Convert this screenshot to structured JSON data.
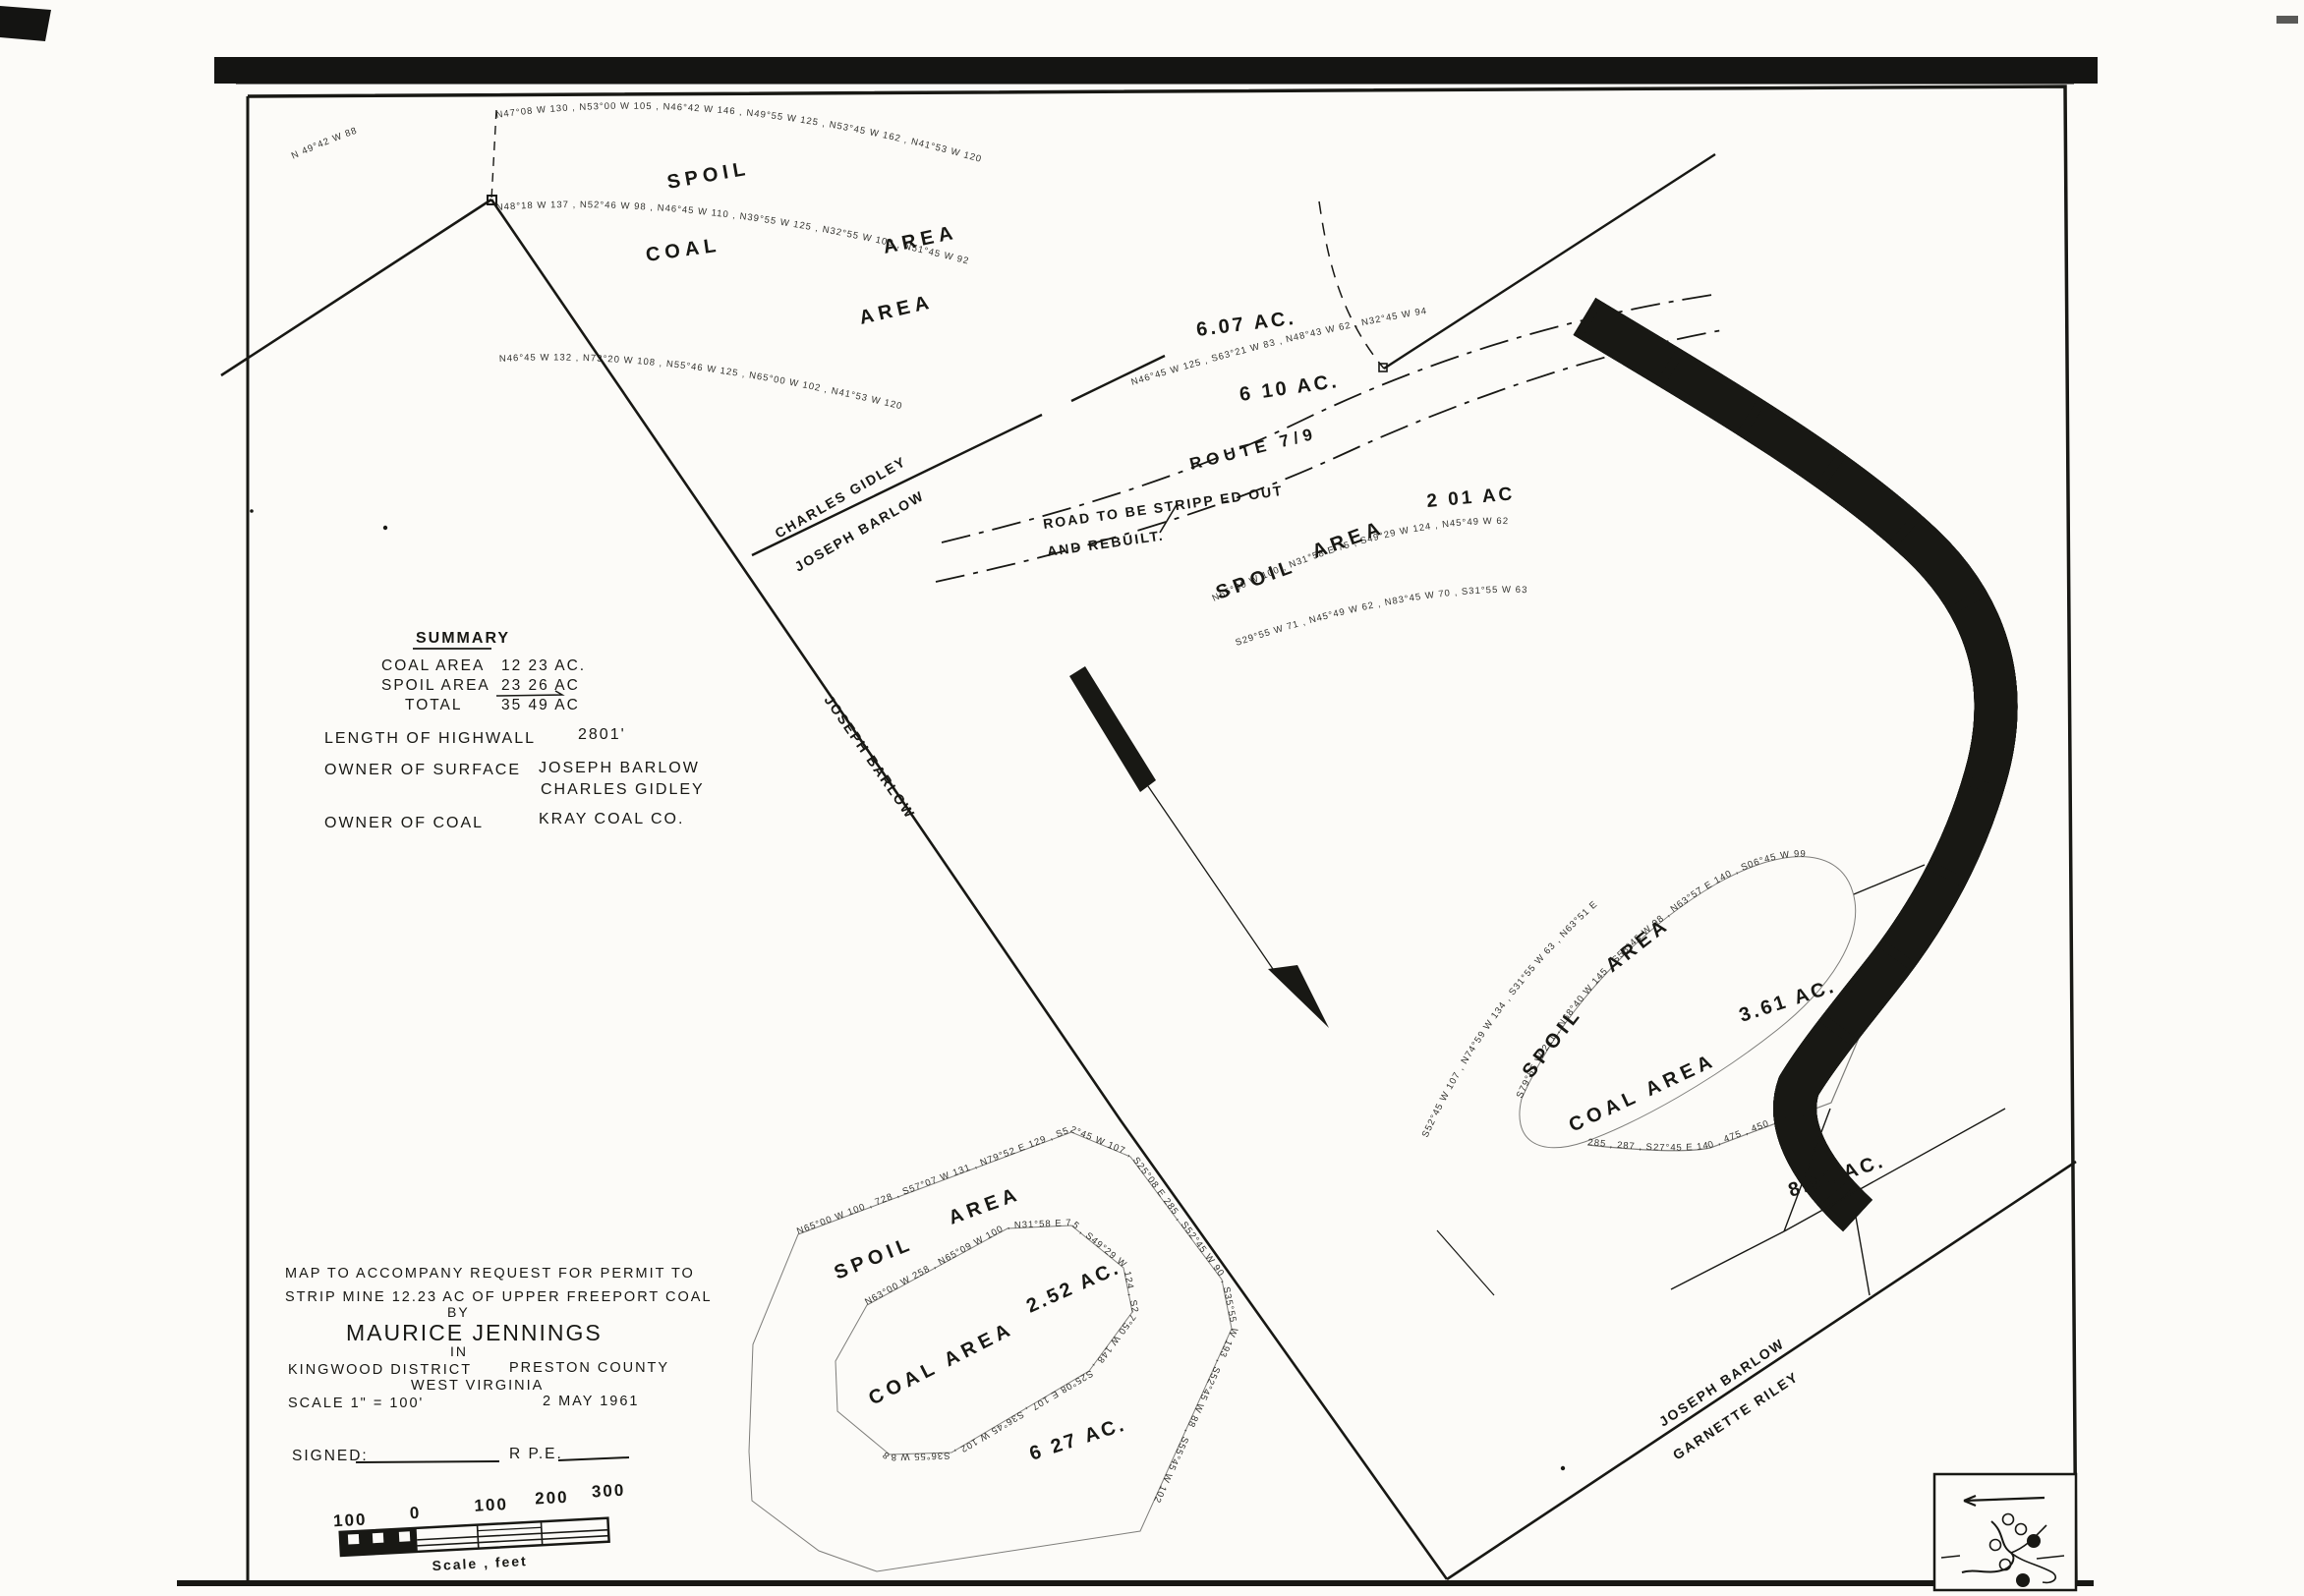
{
  "colors": {
    "ink": "#181814",
    "paper": "#fcfbf8"
  },
  "summary": {
    "heading": "SUMMARY",
    "coal_label": "COAL   AREA",
    "coal_value": "12 23  AC.",
    "spoil_label": "SPOIL  AREA",
    "spoil_value": "23 26 AC",
    "total_label": "TOTAL",
    "total_value": "35 49 AC",
    "highwall_label": "LENGTH  OF  HIGHWALL",
    "highwall_value": "2801'",
    "surface_label": "OWNER  OF  SURFACE",
    "surface_value_1": "JOSEPH  BARLOW",
    "surface_value_2": "CHARLES  GIDLEY",
    "coal_owner_label": "OWNER  OF  COAL",
    "coal_owner_value": "KRAY  COAL  CO."
  },
  "title_block": {
    "line1": "MAP  TO  ACCOMPANY  REQUEST  FOR  PERMIT  TO",
    "line2": "STRIP  MINE  12.23  AC   OF  UPPER  FREEPORT  COAL",
    "by": "BY",
    "name": "MAURICE  JENNINGS",
    "in": "IN",
    "district": "KINGWOOD  DISTRICT",
    "county": "PRESTON  COUNTY",
    "state": "WEST  VIRGINIA",
    "scale": "SCALE  1\" =  100'",
    "date": "2  MAY  1961",
    "signed_label": "SIGNED:",
    "rpe": "R P.E."
  },
  "scale_bar": {
    "l0": "100",
    "l1": "0",
    "l2": "100",
    "l3": "200",
    "l4": "300",
    "caption": "Scale , feet"
  },
  "map_labels": {
    "spoil_upper": "SPOIL",
    "area_upper": "AREA",
    "coal_upper": "COAL",
    "area_upper2": "AREA",
    "ac_607": "6.07  AC.",
    "ac_610": "6 10  AC.",
    "route": "ROUTE    7/9",
    "road_note_1": "ROAD  TO  BE  STRIPP ED  OUT",
    "road_note_2": "AND  REBUILT.",
    "ac_201": "2 01  AC",
    "spoil_mid": "SPOIL",
    "area_mid": "AREA",
    "charles_gidley": "CHARLES  GIDLEY",
    "joseph_barlow_upper": "JOSEPH  BARLOW",
    "joseph_barlow_line": "JOSEPH   BARLOW",
    "spoil_right": "SPOIL",
    "area_right": "AREA",
    "coal_area_right": "COAL  AREA",
    "ac_361": "3.61  AC.",
    "ac_891": "8.91  AC.",
    "spoil_bottom": "SPOIL",
    "area_bottom": "AREA",
    "coal_area_bottom": "COAL  AREA",
    "ac_252": "2.52  AC.",
    "ac_627": "6 27  AC.",
    "joseph_barlow_lower": "JOSEPH  BARLOW",
    "garnette_riley": "GARNETTE  RILEY"
  },
  "bearings": {
    "r0": "N 49°42 W  88",
    "r1": "N47°08 W 130 ,  N53°00 W 105 ,  N46°42 W 146 ,  N49°55 W 125 ,  N53°45 W 162 ,  N41°53 W 120",
    "r2": "N48°18 W 137 ,  N52°46 W 98 ,  N46°45 W 110 ,  N39°55 W 125 ,  N32°55 W 100 ,  N51°45 W 92",
    "r3": "N46°45 W 132 ,  N73°20 W 108 ,  N55°46 W 125 ,  N65°00 W 102 ,  N41°53 W 120",
    "r4": "N46°45 W 125 ,  S63°21 W 83 ,  N48°43 W 62 ,  N32°45 W 94",
    "s1": "N65°00 W 100 ,  N31°58 E 75 ,  S49°29 W 124 ,  N45°49 W 62",
    "s2": "S29°55 W 71 ,  N45°49 W 62 ,  N83°45 W 70 ,  S31°55 W 63",
    "kidney": "S79°55 W 211 ,  N68°40 W 145 ,  S58°45 W 98 ,  N63°57 E 140 ,  S06°45 W 99",
    "arc": "S52°45 W 107 ,  N74°59 W 134 ,  S31°55 W 63 ,  N63°51 E",
    "oring": "N65°00 W 100 , 728 , S57°07 W 131 , N79°52 E 129 , S52°45 W 107 , S25°08 E 285 , S52°45 W 90 , S35°55 W 193 , S52°45 W 88 , S55°45 W 102",
    "iring": "N63°00 W 258 , N65°09 W 100 , N31°58 E 75 , S49°29 W 124 , S27°50 W 148 , S25°08 E 107 , S36°45 W 102 , S36°55 W 88",
    "e891": "285 ,  287 ,  S27°45 E 140 ,  475 ,  450"
  }
}
